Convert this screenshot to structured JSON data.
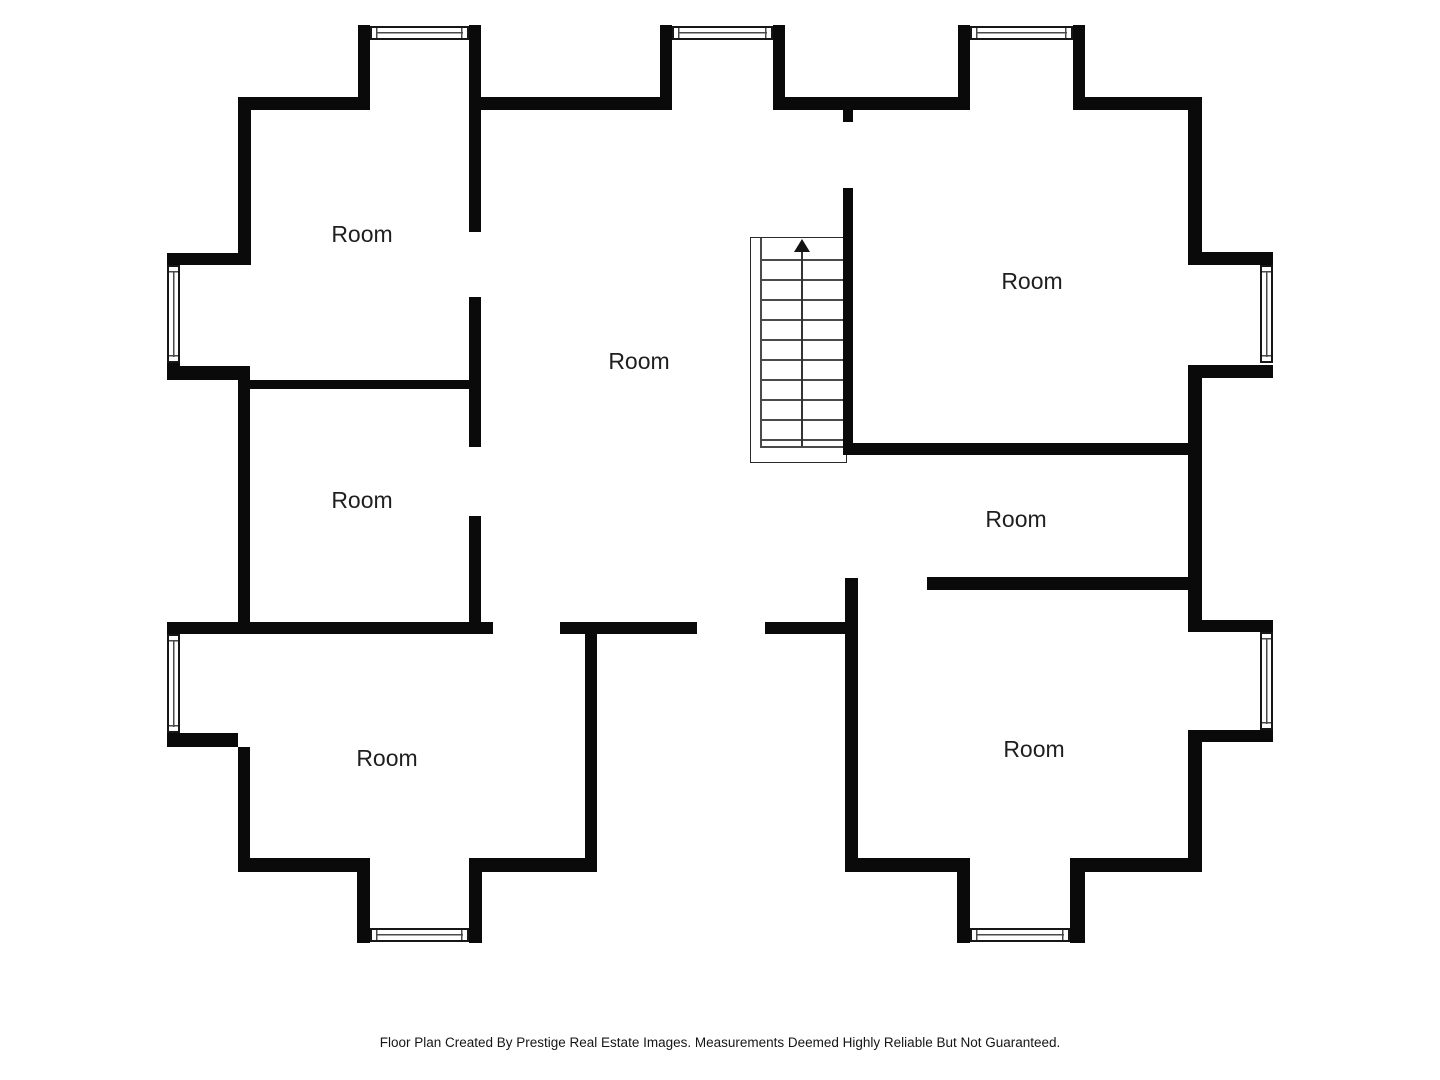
{
  "theme": {
    "wall": "#0a0a0a",
    "thin_line": "#4a4a4a",
    "window_border": "#161616",
    "label_color": "#1f1f1f",
    "footer_color": "#161616",
    "background": "#ffffff"
  },
  "plan": {
    "rooms": [
      {
        "id": "top-left",
        "label": "Room"
      },
      {
        "id": "middle-left",
        "label": "Room"
      },
      {
        "id": "center",
        "label": "Room"
      },
      {
        "id": "top-right",
        "label": "Room"
      },
      {
        "id": "hallway",
        "label": "Room"
      },
      {
        "id": "bottom-left",
        "label": "Room"
      },
      {
        "id": "bottom-right",
        "label": "Room"
      }
    ],
    "stairs": {
      "direction": "up",
      "treads": 11
    }
  },
  "footer": {
    "text": "Floor Plan Created By Prestige Real Estate Images. Measurements Deemed Highly Reliable But Not Guaranteed."
  }
}
